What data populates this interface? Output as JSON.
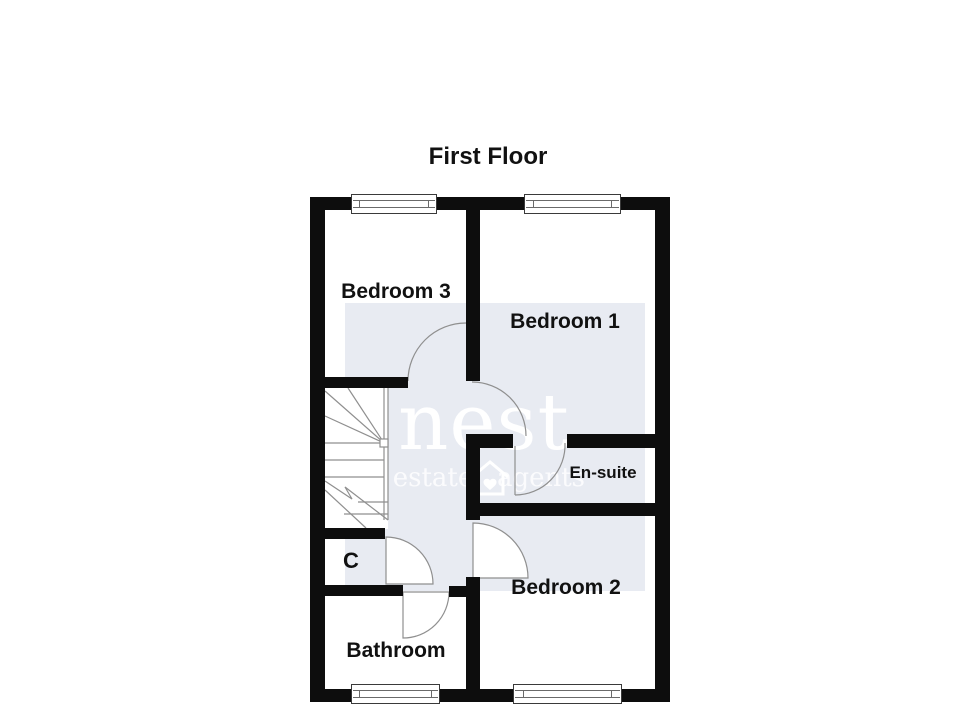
{
  "title": "First Floor",
  "rooms": {
    "bedroom3": "Bedroom 3",
    "bedroom1": "Bedroom 1",
    "ensuite": "En-suite",
    "bedroom2": "Bedroom 2",
    "bathroom": "Bathroom",
    "cupboard": "C"
  },
  "watermark": {
    "brand": "nest",
    "tagline_left": "estate",
    "tagline_right": "agents",
    "icon": "house-heart-icon"
  },
  "colors": {
    "background": "#ffffff",
    "wall": "#0d0d0d",
    "label": "#111111",
    "line": "#8f8f8f",
    "watermark_panel": "#e8ebf2",
    "watermark_text": "#ffffff",
    "watermark_sub": "rgba(255,255,255,0.8)"
  }
}
